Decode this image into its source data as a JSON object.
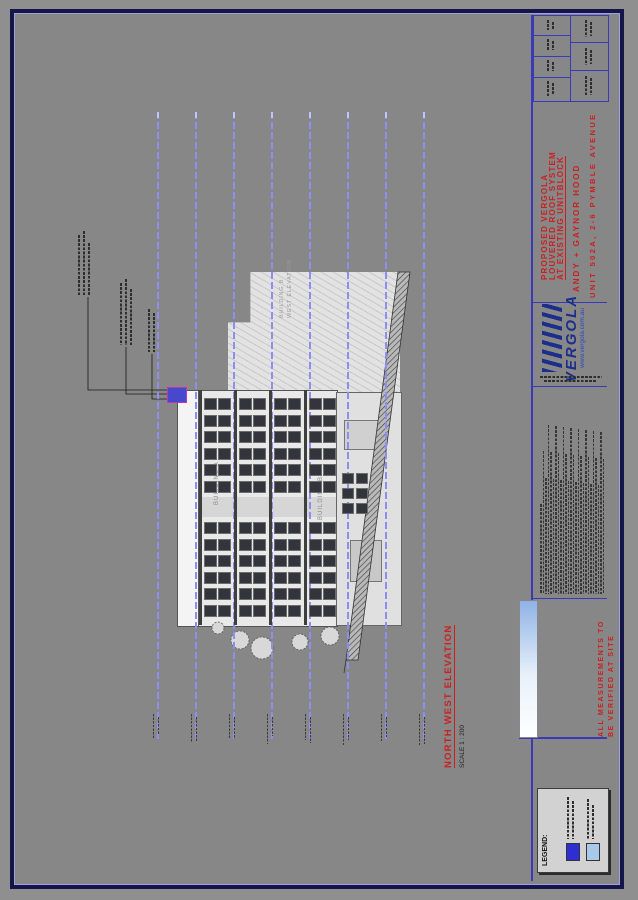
{
  "drawing_sheet": {
    "view": {
      "title": "NORTH WEST ELEVATION",
      "scale_label": "SCALE 1 : 200"
    },
    "title_block": {
      "project_lines": [
        "PROPOSED VERGOLA",
        "LOUVERED ROOF SYSTEM",
        "AT EXISTING UNITBLOCK"
      ],
      "client": "ANDY + GAYNOR HOOD",
      "site_address": "UNIT 502A, 2-6 PYMBLE AVENUE",
      "brand": "VERGOLA",
      "brand_website": "www.vergola.com.au",
      "measurement_note_lines": [
        "ALL MEASUREMENTS TO",
        "BE VERIFIED AT SITE"
      ]
    },
    "legend": {
      "title": "LEGEND:",
      "items": [
        {
          "swatch_color": "#2e2ed2"
        },
        {
          "swatch_color": "#a9c9ea"
        }
      ]
    },
    "elevation_labels": {
      "building_a": "BUILDING A",
      "building_b": "BUILDING B",
      "beyond_line1": "BUILDING B",
      "beyond_line2": "WEST ELEVATION"
    },
    "colors": {
      "level_line_blue": "#8d8df2",
      "title_red": "#cc1f1f",
      "logo_navy": "#1b2f8a",
      "sheet_border_navy": "#15154a",
      "new_roof_mark": "#4848cc"
    }
  }
}
